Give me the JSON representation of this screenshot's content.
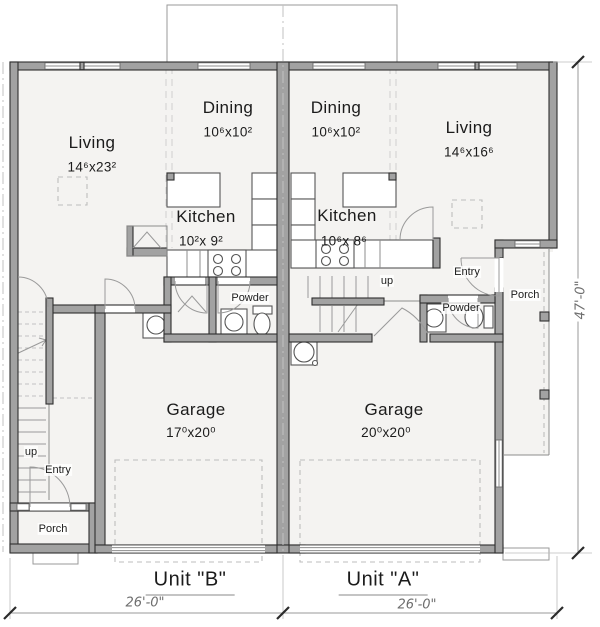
{
  "title": "Duplex main floor plan",
  "units": {
    "b": {
      "label": "Unit \"B\"",
      "width_dim": "26'-0\""
    },
    "a": {
      "label": "Unit \"A\"",
      "width_dim": "26'-0\""
    }
  },
  "overall": {
    "height_dim": "47'-0\""
  },
  "rooms": {
    "living_b": {
      "label": "Living",
      "dims": "14⁶x23²"
    },
    "dining_b": {
      "label": "Dining",
      "dims": "10⁶x10²"
    },
    "kitchen_b": {
      "label": "Kitchen",
      "dims": "10²x 9²"
    },
    "powder_b": {
      "label": "Powder"
    },
    "garage_b": {
      "label": "Garage",
      "dims": "17⁰x20⁰"
    },
    "entry_b": {
      "label": "Entry"
    },
    "porch_b": {
      "label": "Porch"
    },
    "up_b": {
      "label": "up"
    },
    "living_a": {
      "label": "Living",
      "dims": "14⁶x16⁶"
    },
    "dining_a": {
      "label": "Dining",
      "dims": "10⁶x10²"
    },
    "kitchen_a": {
      "label": "Kitchen",
      "dims": "10⁶x 8⁶"
    },
    "powder_a": {
      "label": "Powder"
    },
    "garage_a": {
      "label": "Garage",
      "dims": "20⁰x20⁰"
    },
    "entry_a": {
      "label": "Entry"
    },
    "porch_a": {
      "label": "Porch"
    },
    "up_a": {
      "label": "up"
    }
  },
  "colors": {
    "wall": "#a2a2a2",
    "wall_edge": "#2f2f2f",
    "floor": "#f4f3f1",
    "line": "#8c8c8c",
    "dash": "#c6c6c6",
    "text": "#1b1b1b",
    "dim_text": "#6e6e6e"
  }
}
